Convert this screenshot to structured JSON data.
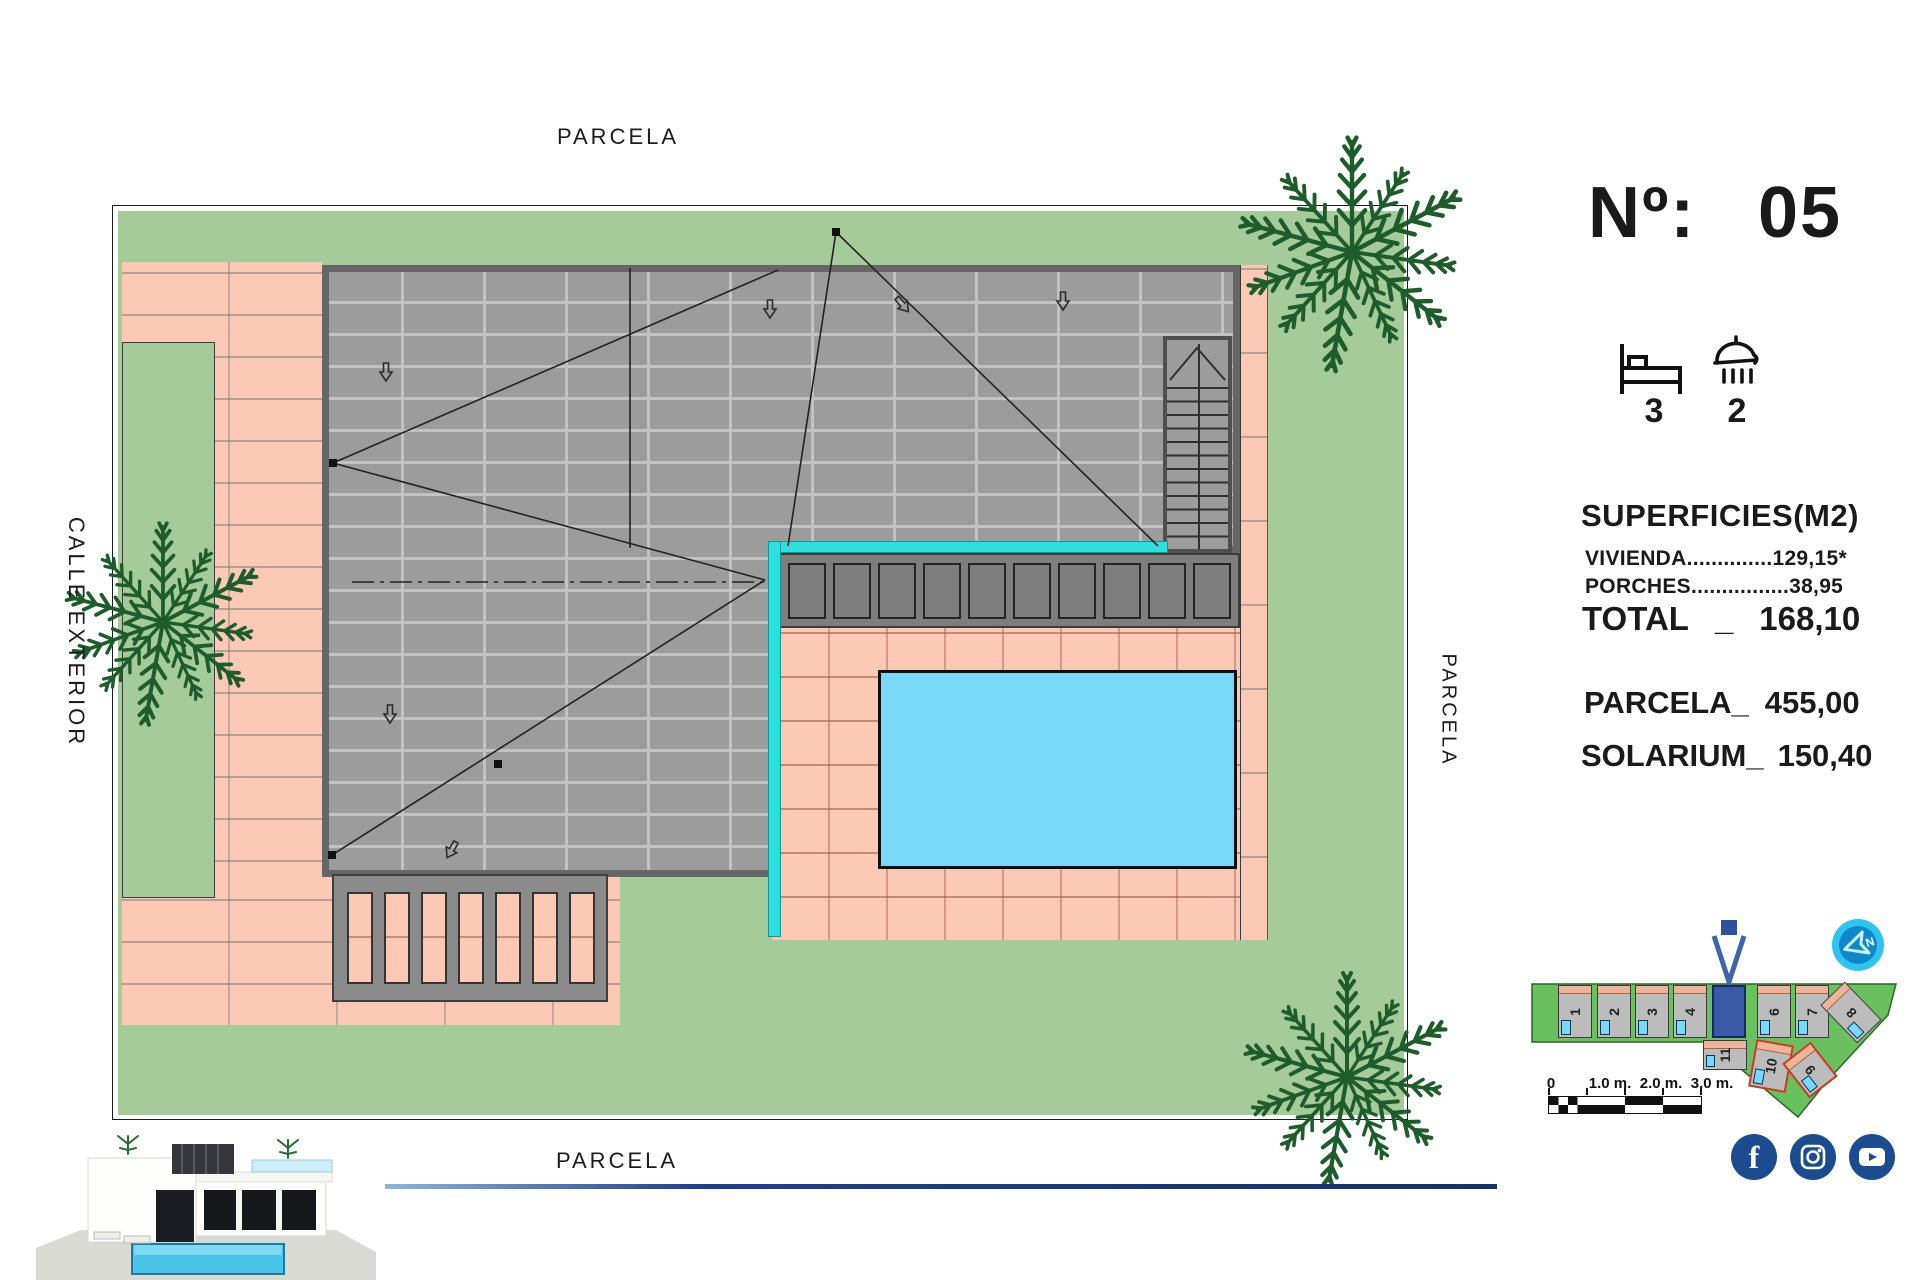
{
  "plan": {
    "label_top": "PARCELA",
    "label_bottom": "PARCELA",
    "label_left": "CALLE EXTERIOR",
    "label_right": "PARCELA"
  },
  "panel": {
    "number_label": "Nº:",
    "number_value": "05",
    "beds": "3",
    "baths": "2",
    "surfaces_title": "SUPERFICIES(M2)",
    "vivienda_line": "VIVIENDA..............129,15*",
    "porches_line": "PORCHES................38,95",
    "total_label": "TOTAL",
    "total_sep": "_",
    "total_value": "168,10",
    "parcela_label": "PARCELA_",
    "parcela_value": "455,00",
    "solarium_label": "SOLARIUM_",
    "solarium_value": "150,40"
  },
  "minimap": {
    "plots_top": [
      "1",
      "2",
      "3",
      "4"
    ],
    "plots_right": [
      "6",
      "7",
      "8"
    ],
    "plots_bottom": [
      "11",
      "10",
      "9"
    ],
    "highlighted_plot": "5",
    "scale_ticks": [
      "0",
      "1.0 m.",
      "2.0 m.",
      "3.0 m."
    ],
    "compass_n": "N"
  },
  "social": {
    "names": [
      "facebook",
      "instagram",
      "youtube"
    ]
  },
  "colors": {
    "grass": "#a5cb9b",
    "paving": "#fbc9b5",
    "roof": "#9c9c9c",
    "roof_edge": "#666666",
    "pool": "#7ad8f8",
    "glass_fence": "#2ae1de",
    "porch_gray": "#7e7e7e",
    "palm_green": "#1e5c2b",
    "navy": "#1d4b8f",
    "minimap_green": "#6abf5e",
    "highlight_blue": "#3b5aa6",
    "compass_cyan": "#2fc4ef"
  }
}
